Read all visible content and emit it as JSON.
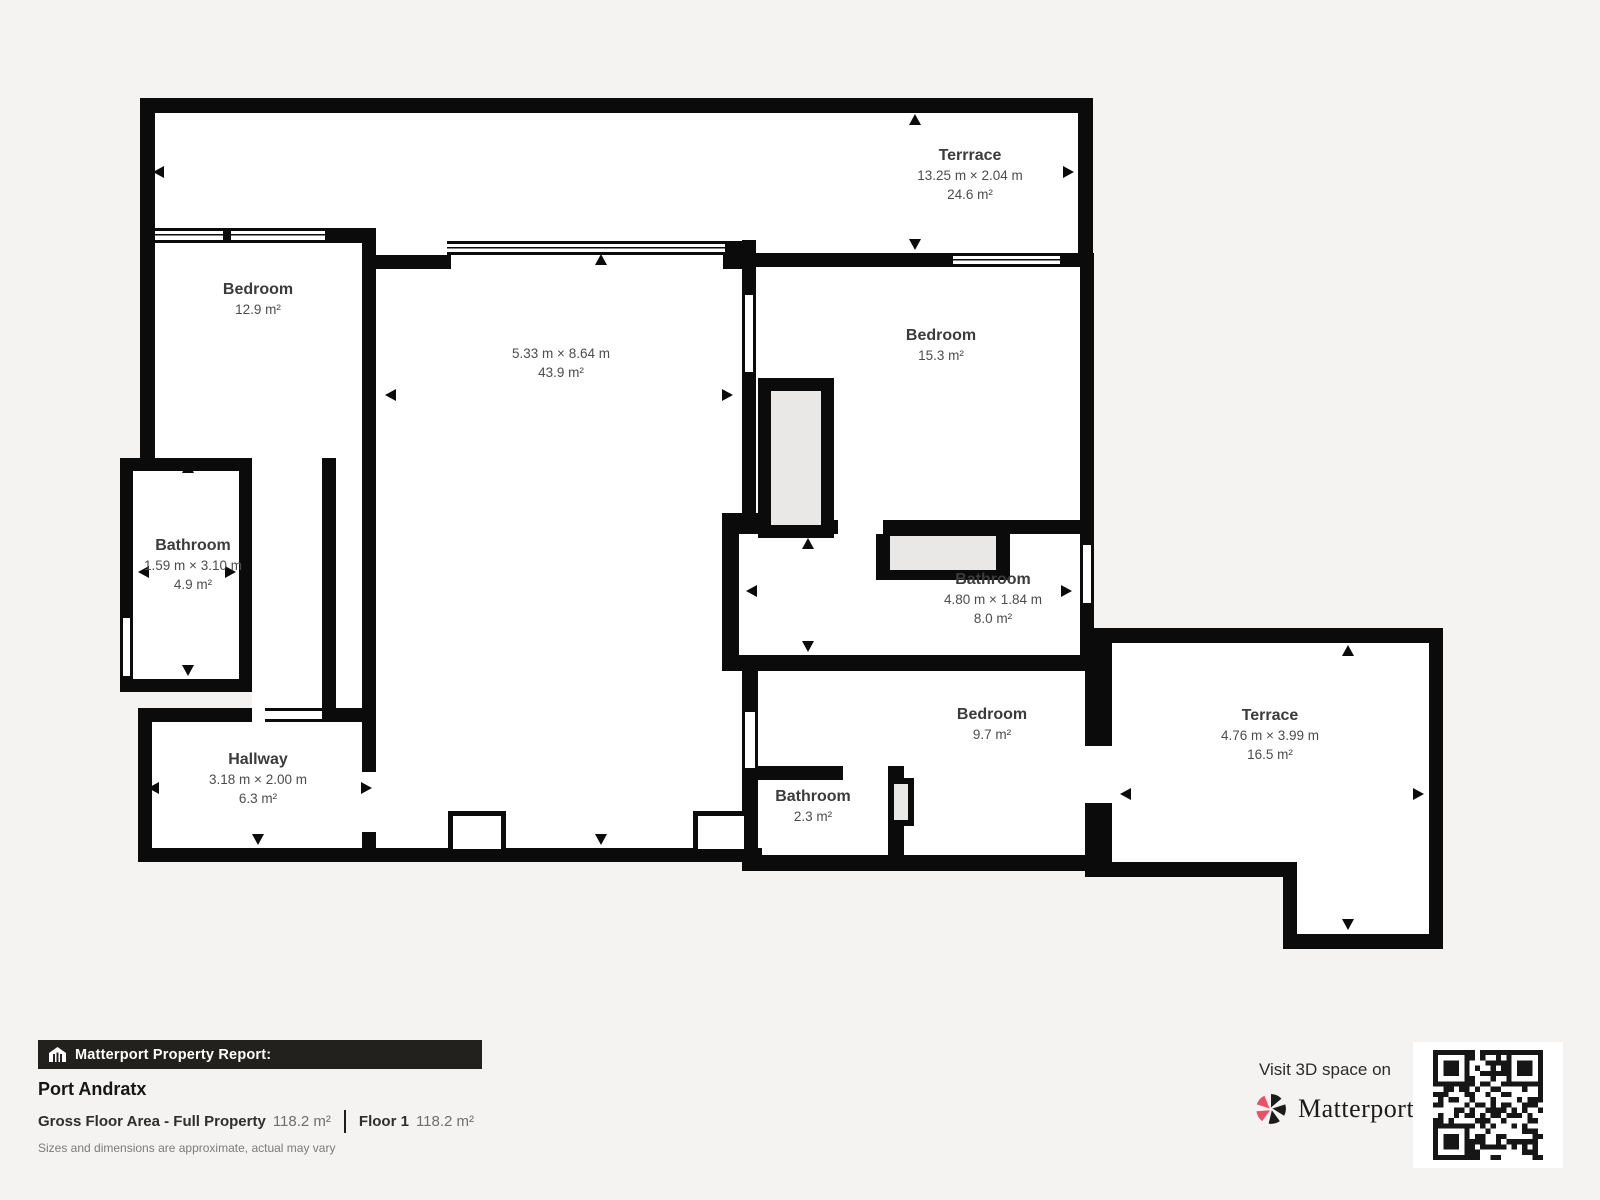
{
  "plan": {
    "rooms": [
      {
        "id": "terrace-top",
        "name": "Terrrace",
        "dims": "13.25 m × 2.04 m",
        "area": "24.6 m²"
      },
      {
        "id": "bedroom-1",
        "name": "Bedroom",
        "dims": "",
        "area": "12.9 m²"
      },
      {
        "id": "living-room",
        "name": "",
        "dims": "5.33 m × 8.64 m",
        "area": "43.9 m²"
      },
      {
        "id": "bedroom-2",
        "name": "Bedroom",
        "dims": "",
        "area": "15.3 m²"
      },
      {
        "id": "bathroom-1",
        "name": "Bathroom",
        "dims": "1.59 m × 3.10 m",
        "area": "4.9 m²"
      },
      {
        "id": "bathroom-2",
        "name": "Bathroom",
        "dims": "4.80 m × 1.84 m",
        "area": "8.0 m²"
      },
      {
        "id": "bedroom-3",
        "name": "Bedroom",
        "dims": "",
        "area": "9.7 m²"
      },
      {
        "id": "bathroom-3",
        "name": "Bathroom",
        "dims": "",
        "area": "2.3 m²"
      },
      {
        "id": "terrace-2",
        "name": "Terrace",
        "dims": "4.76 m × 3.99 m",
        "area": "16.5 m²"
      },
      {
        "id": "hallway",
        "name": "Hallway",
        "dims": "3.18 m × 2.00 m",
        "area": "6.3 m²"
      }
    ]
  },
  "footer": {
    "report_label": "Matterport Property Report:",
    "property_name": "Port Andratx",
    "gfa_label": "Gross Floor Area - Full Property",
    "gfa_value": "118.2 m²",
    "floor_label": "Floor 1",
    "floor_value": "118.2 m²",
    "disclaimer": "Sizes and dimensions are approximate, actual may vary"
  },
  "promo": {
    "visit_text": "Visit 3D space on",
    "brand": "Matterport",
    "brand_mark": "·"
  },
  "colors": {
    "background": "#f4f3f1",
    "wall": "#0b0b0b",
    "room_fill": "#ffffff",
    "niche_fill": "#e9e8e6",
    "accent_pink": "#e9506a",
    "bar_background": "#23211d"
  }
}
